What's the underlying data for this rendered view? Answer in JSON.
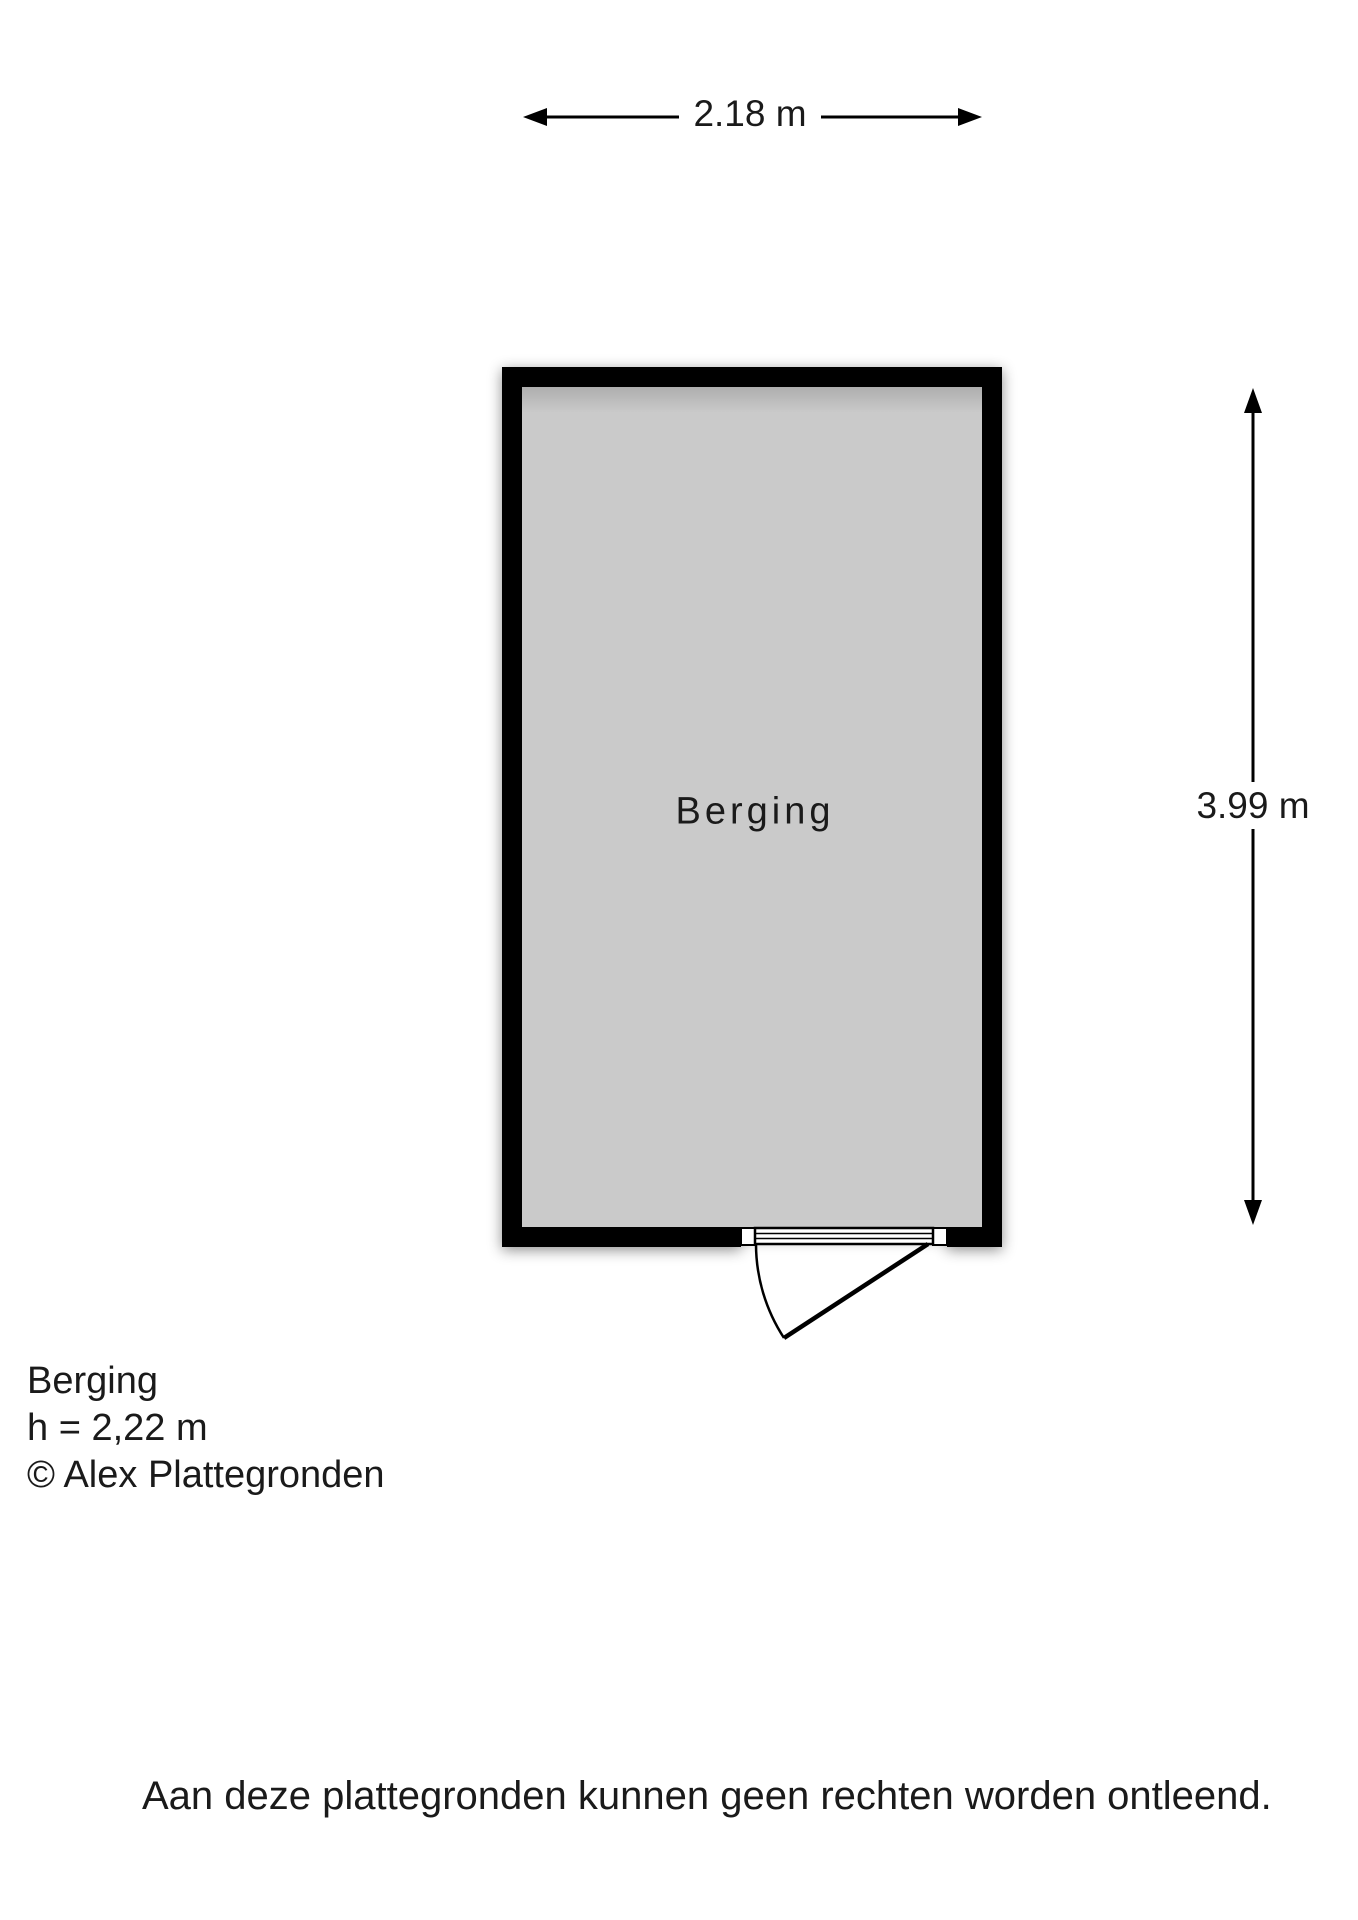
{
  "page": {
    "background": "#ffffff"
  },
  "plan": {
    "room_label": "Berging",
    "floor_color": "#cacaca",
    "wall_color": "#000000",
    "dim_width_label": "2.18 m",
    "dim_height_label": "3.99 m"
  },
  "legend": {
    "room_name": "Berging",
    "ceiling_height": "h = 2,22 m",
    "copyright": "© Alex Plattegronden"
  },
  "disclaimer": "Aan deze plattegronden kunnen geen rechten worden ontleend."
}
